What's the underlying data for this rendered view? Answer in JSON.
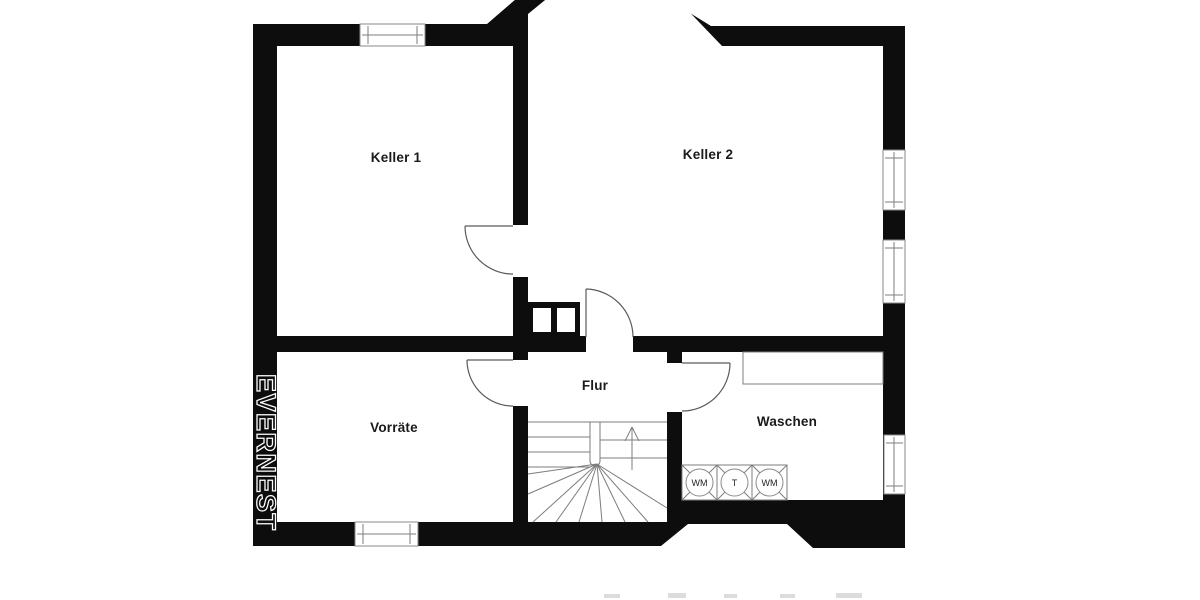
{
  "plan": {
    "watermark": "EVERNEST",
    "rooms": {
      "keller1": "Keller 1",
      "keller2": "Keller 2",
      "vorraete": "Vorräte",
      "flur": "Flur",
      "waschen": "Waschen"
    },
    "appliances": {
      "a1": "WM",
      "a2": "T",
      "a3": "WM"
    },
    "colors": {
      "wall": "#0d0d0d",
      "thin_line": "#7d7d7d",
      "label": "#1a1a1a",
      "watermark_stroke": "#ffffff",
      "background": "#ffffff"
    }
  }
}
